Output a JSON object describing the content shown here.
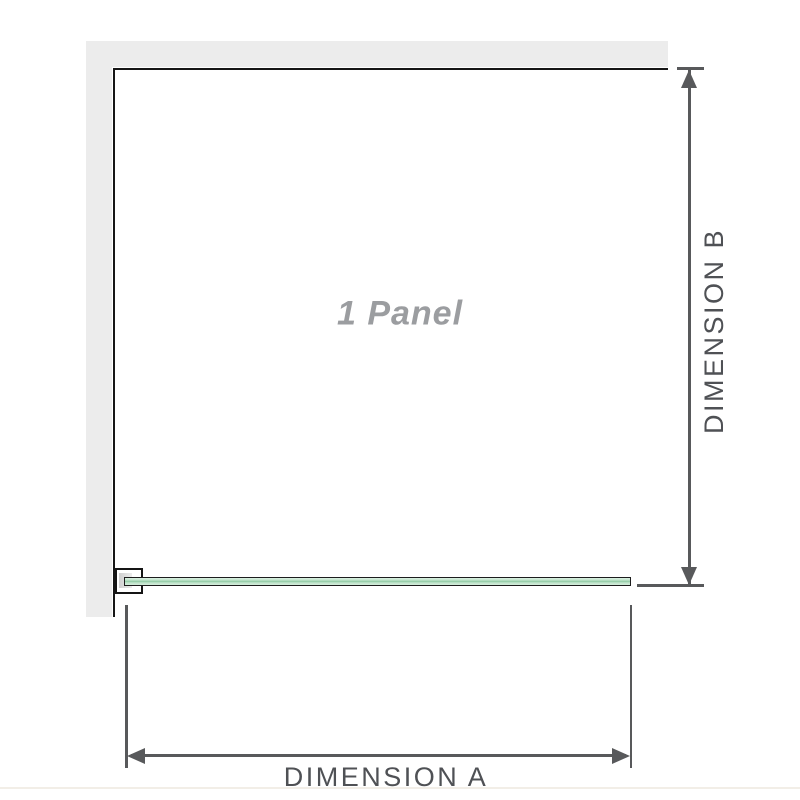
{
  "diagram": {
    "panel_label": "1 Panel",
    "dimension_a_label": "DIMENSION A",
    "dimension_b_label": "DIMENSION B",
    "colors": {
      "wall_fill": "#ececec",
      "wall_edge": "#161616",
      "dimension_line": "#58595b",
      "dimension_text": "#4f5155",
      "panel_label_text": "#9b9da0",
      "glass_fill": "#c0e4cb",
      "glass_stripe": "#8fc9a2",
      "glass_outline": "#1d1d1d"
    }
  }
}
